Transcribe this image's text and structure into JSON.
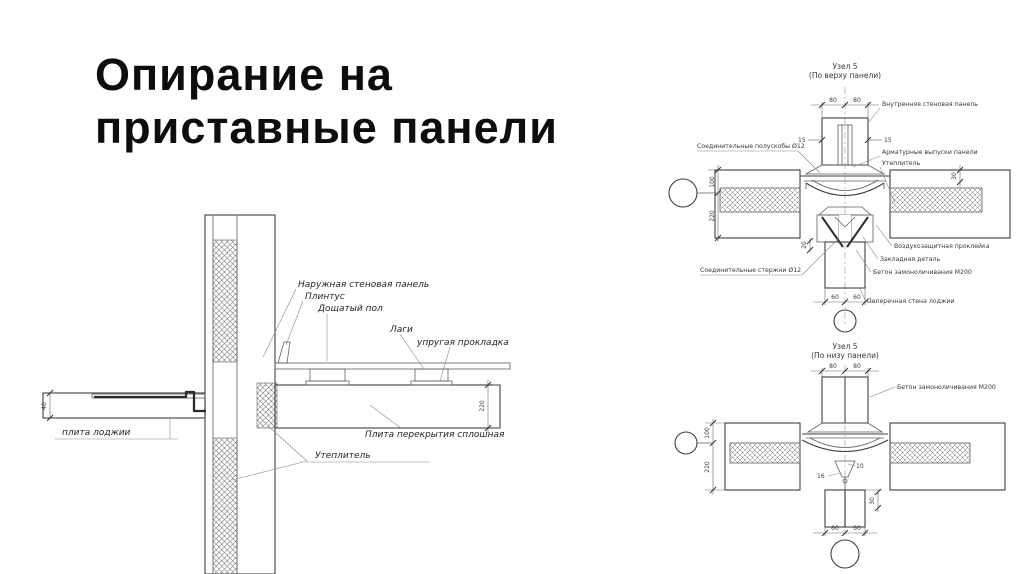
{
  "slide": {
    "title_line1": "Опирание на",
    "title_line2": "приставные панели"
  },
  "colors": {
    "background": "#ffffff",
    "ink": "#1a1a1a"
  },
  "left_drawing": {
    "labels": {
      "outer_wall_panel": "Наружная стеновая панель",
      "plinth": "Плинтус",
      "plank_floor": "Дощатый пол",
      "joists": "Лаги",
      "elastic_gasket": "упругая прокладка",
      "loggia_slab": "плита лоджии",
      "solid_floor_slab": "Плита перекрытия сплошная",
      "insulation": "Утеплитель"
    },
    "dims": {
      "slab_thickness": "220",
      "loggia_lip": "40"
    }
  },
  "node_top": {
    "title": "Узел 5",
    "subtitle": "(По верху панели)",
    "labels": {
      "inner_wall_panel": "Внутренняя стеновая панель",
      "rebar_outlets": "Арматурные выпуски панели",
      "insulation": "Утеплитель",
      "half_brackets": "Соединительные полускобы Ø12",
      "air_tape": "Воздухозащитная проклейка",
      "embedded_part": "Закладная деталь",
      "grout_concrete": "Бетон замоноличивания М200",
      "connecting_rods": "Соединительные стержни Ø12",
      "cross_wall": "Поперечная стена лоджии"
    },
    "dims": {
      "d80a": "80",
      "d80b": "80",
      "d15l": "15",
      "d15r": "15",
      "d30r": "30",
      "d100": "100",
      "d220": "220",
      "d20": "20",
      "d60a": "60",
      "d60b": "60"
    }
  },
  "node_bottom": {
    "title": "Узел 5",
    "subtitle": "(По низу панели)",
    "labels": {
      "grout_concrete": "Бетон замоноличивания М200"
    },
    "dims": {
      "d80a": "80",
      "d80b": "80",
      "d100": "100",
      "d220": "220",
      "d10": "10",
      "d16": "16",
      "d30": "30",
      "d60a": "60",
      "d60b": "60"
    }
  }
}
